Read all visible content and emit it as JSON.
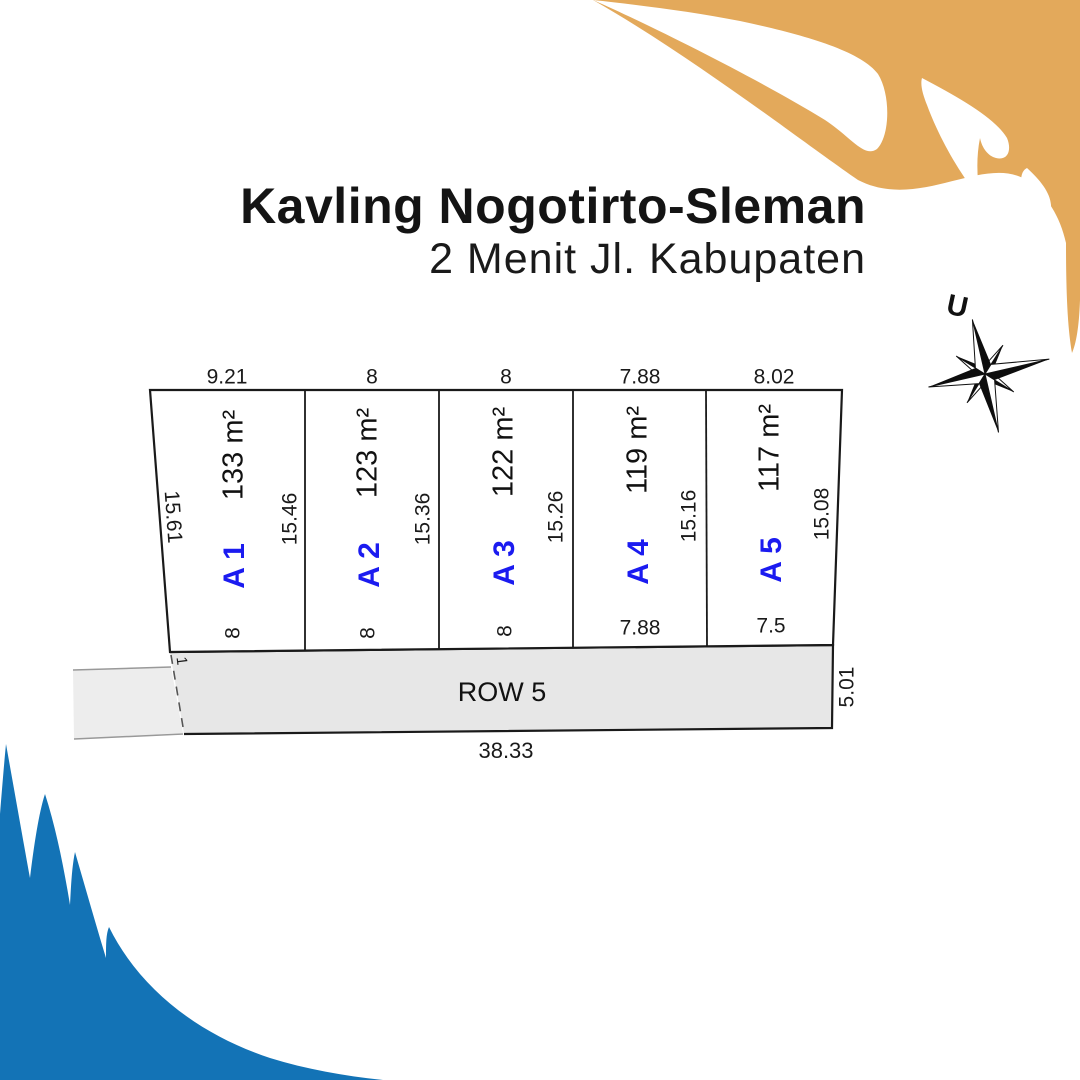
{
  "poster": {
    "title": "Kavling Nogotirto-Sleman",
    "subtitle": "2 Menit Jl. Kabupaten"
  },
  "compass": {
    "north_label": "U"
  },
  "site_plan": {
    "left_side_dim": "15.61",
    "plots": [
      {
        "id": "A 1",
        "area": "133 m²",
        "top_dim": "9.21",
        "bottom_dim": "8",
        "side_dim": "15.46"
      },
      {
        "id": "A 2",
        "area": "123 m²",
        "top_dim": "8",
        "bottom_dim": "8",
        "side_dim": "15.36"
      },
      {
        "id": "A 3",
        "area": "122 m²",
        "top_dim": "8",
        "bottom_dim": "8",
        "side_dim": "15.26"
      },
      {
        "id": "A 4",
        "area": "119 m²",
        "top_dim": "7.88",
        "bottom_dim": "7.88",
        "side_dim": "15.16"
      },
      {
        "id": "A 5",
        "area": "117 m²",
        "top_dim": "8.02",
        "bottom_dim": "7.5",
        "side_dim": "15.08"
      }
    ],
    "road": {
      "label": "ROW 5",
      "bottom_dim": "38.33",
      "right_dim": "5.01",
      "left_gap_dim": "1"
    }
  },
  "colors": {
    "accent_orange": "#e3a95b",
    "accent_blue": "#1373b6",
    "plot_label_blue": "#1b1bf0"
  }
}
